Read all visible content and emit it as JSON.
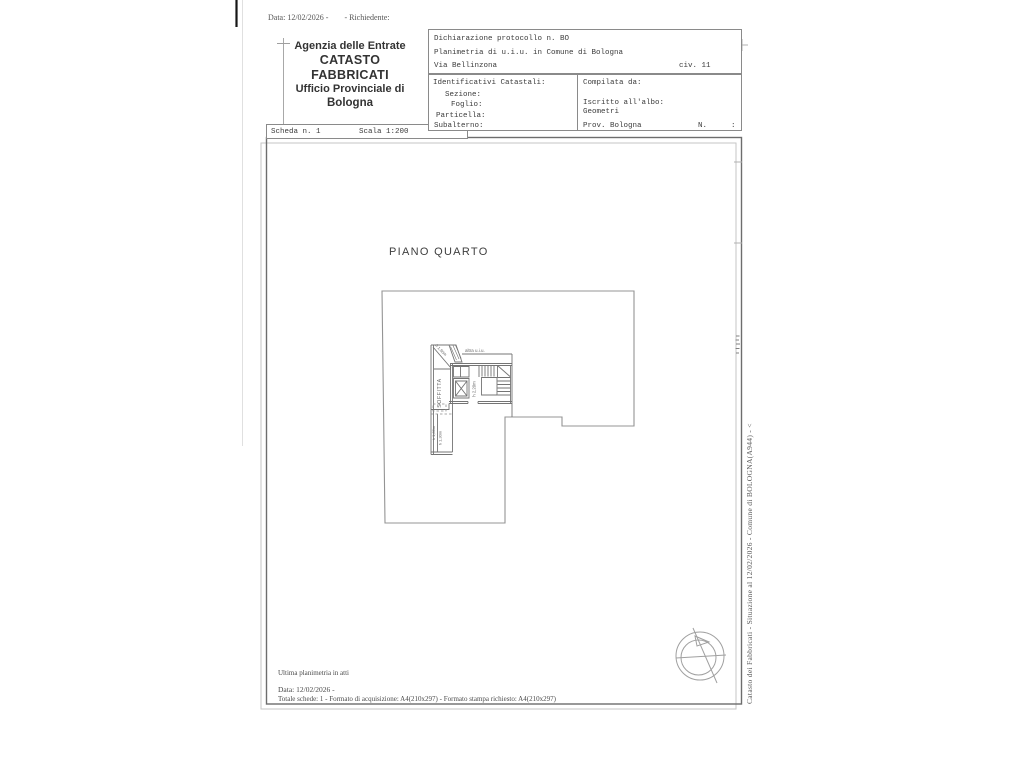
{
  "meta_top": {
    "date": "Data: 12/02/2026 -",
    "richiedente": "- Richiedente:"
  },
  "office_header": {
    "line1": "Agenzia delle Entrate",
    "line2": "CATASTO FABBRICATI",
    "line3": "Ufficio Provinciale di",
    "line4": "Bologna"
  },
  "scheda_bar": {
    "scheda": "Scheda n. 1",
    "scala": "Scala 1:200"
  },
  "declaration": {
    "protocol": "Dichiarazione protocollo n. BO",
    "planimetria": "Planimetria di u.i.u. in Comune di Bologna",
    "street": "Via Bellinzona",
    "civ": "civ. 11"
  },
  "identificativi": {
    "title": "Identificativi Catastali:",
    "sezione": "Sezione:",
    "foglio": "Foglio:",
    "particella": "Particella:",
    "subalterno": "Subalterno:"
  },
  "compilata": {
    "title": "Compilata da:",
    "albo_label": "Iscritto all'albo:",
    "albo_value": "Geometri",
    "prov": "Prov. Bologna",
    "n": "N.",
    "colon": ":"
  },
  "plan": {
    "floor_title": "PIANO QUARTO",
    "room_label": "SOFFITTA",
    "adjacent_label": "altra u.i.u.",
    "h_diag": "h 1,90m",
    "h_elevator": "h 2,20m",
    "h_low1": "h 1,86m",
    "h_low2": "h 1,30m"
  },
  "margin_caption": "Catasto dei Fabbricati - Situazione al 12/02/2026 - Comune di BOLOGNA(A944) - <",
  "footer": {
    "line1": "Ultima planimetria in atti",
    "line2": "Data: 12/02/2026 -",
    "line3": "Totale schede: 1 - Formato di acquisizione: A4(210x297) - Formato stampa richiesto: A4(210x297)"
  },
  "colors": {
    "frame": "#6d6d6d",
    "ghost_frame": "#c6c6c6",
    "building_line": "#949494",
    "core_line": "#747474",
    "ink": "#3b3b3b"
  }
}
